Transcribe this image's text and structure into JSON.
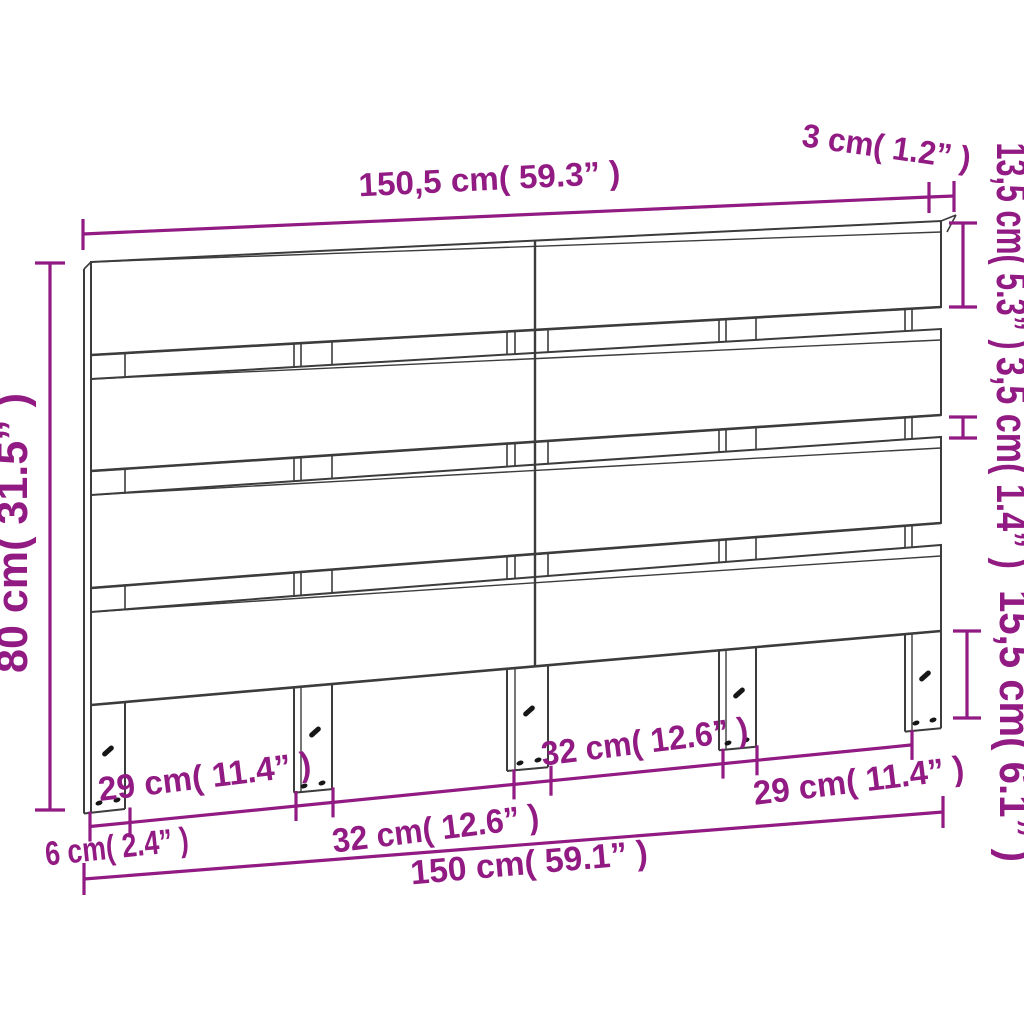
{
  "diagram_type": "product-dimension-drawing",
  "colors": {
    "dimension_accent": "#911a83",
    "drawing_line": "#3c3c3c",
    "background": "#ffffff"
  },
  "dimensions": {
    "top_width": "150,5 cm( 59.3” )",
    "depth": "3 cm( 1.2” )",
    "plank_height": "13,5 cm( 5.3” )",
    "plank_gap": "3,5 cm( 1.4” )",
    "leg_height": "15,5 cm( 6.1” )",
    "total_height": "80 cm( 31.5” )",
    "gap_left": "29 cm( 11.4” )",
    "gap_mid_left": "32 cm( 12.6” )",
    "gap_mid_right": "32 cm( 12.6” )",
    "gap_right": "29 cm( 11.4” )",
    "leg_width": "6 cm( 2.4” )",
    "bottom_width": "150 cm( 59.1” )"
  }
}
